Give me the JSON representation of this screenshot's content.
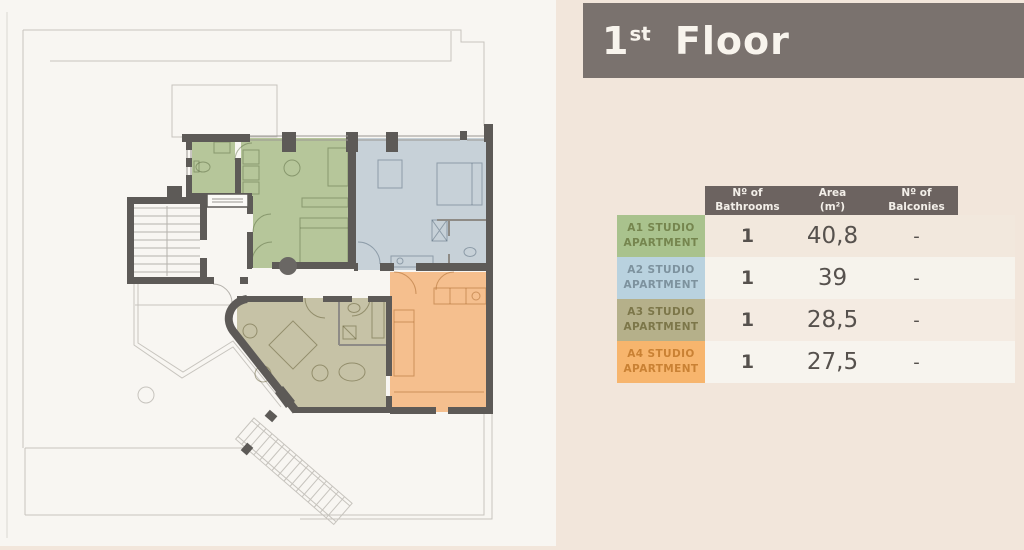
{
  "banner": {
    "number": "1",
    "suffix": "st",
    "word": "Floor",
    "bg": "#7a726e",
    "text_color": "#f8f4ed"
  },
  "table": {
    "header": {
      "bg": "#6c6360",
      "text_color": "#f3efe9",
      "columns": [
        [
          "Nº of",
          "Bathrooms"
        ],
        [
          "Area",
          "(m²)"
        ],
        [
          "Nº of",
          "Balconies"
        ]
      ]
    },
    "values_color": "#56514d",
    "rows": [
      {
        "label": [
          "A1 STUDIO",
          "APARTMENT"
        ],
        "label_bg": "#a9c28d",
        "label_color": "#75854e",
        "row_bg": "#f2e8dd",
        "bathrooms": "1",
        "area": "40,8",
        "balconies": "-"
      },
      {
        "label": [
          "A2 STUDIO",
          "APARTMENT"
        ],
        "label_bg": "#b9d2df",
        "label_color": "#7d929e",
        "row_bg": "#f6f3ec",
        "bathrooms": "1",
        "area": "39",
        "balconies": "-"
      },
      {
        "label": [
          "A3 STUDIO",
          "APARTMENT"
        ],
        "label_bg": "#b5b08a",
        "label_color": "#7c7649",
        "row_bg": "#f4ebe2",
        "bathrooms": "1",
        "area": "28,5",
        "balconies": "-"
      },
      {
        "label": [
          "A4 STUDIO",
          "APARTMENT"
        ],
        "label_bg": "#f7b56d",
        "label_color": "#c98134",
        "row_bg": "#f7f4ee",
        "bathrooms": "1",
        "area": "27,5",
        "balconies": "-"
      }
    ]
  },
  "plan": {
    "wall_color": "#5d5a57",
    "line_color": "#c7c4be",
    "window_color": "#9a9792",
    "apartments": [
      {
        "id": "A1",
        "name": "A1 Studio Apartment",
        "color": "#b6c69a"
      },
      {
        "id": "A2",
        "name": "A2 Studio Apartment",
        "color": "#c7d1d8"
      },
      {
        "id": "A3",
        "name": "A3 Studio Apartment",
        "color": "#c6c2a6"
      },
      {
        "id": "A4",
        "name": "A4 Studio Apartment",
        "color": "#f5bf8e"
      }
    ]
  }
}
